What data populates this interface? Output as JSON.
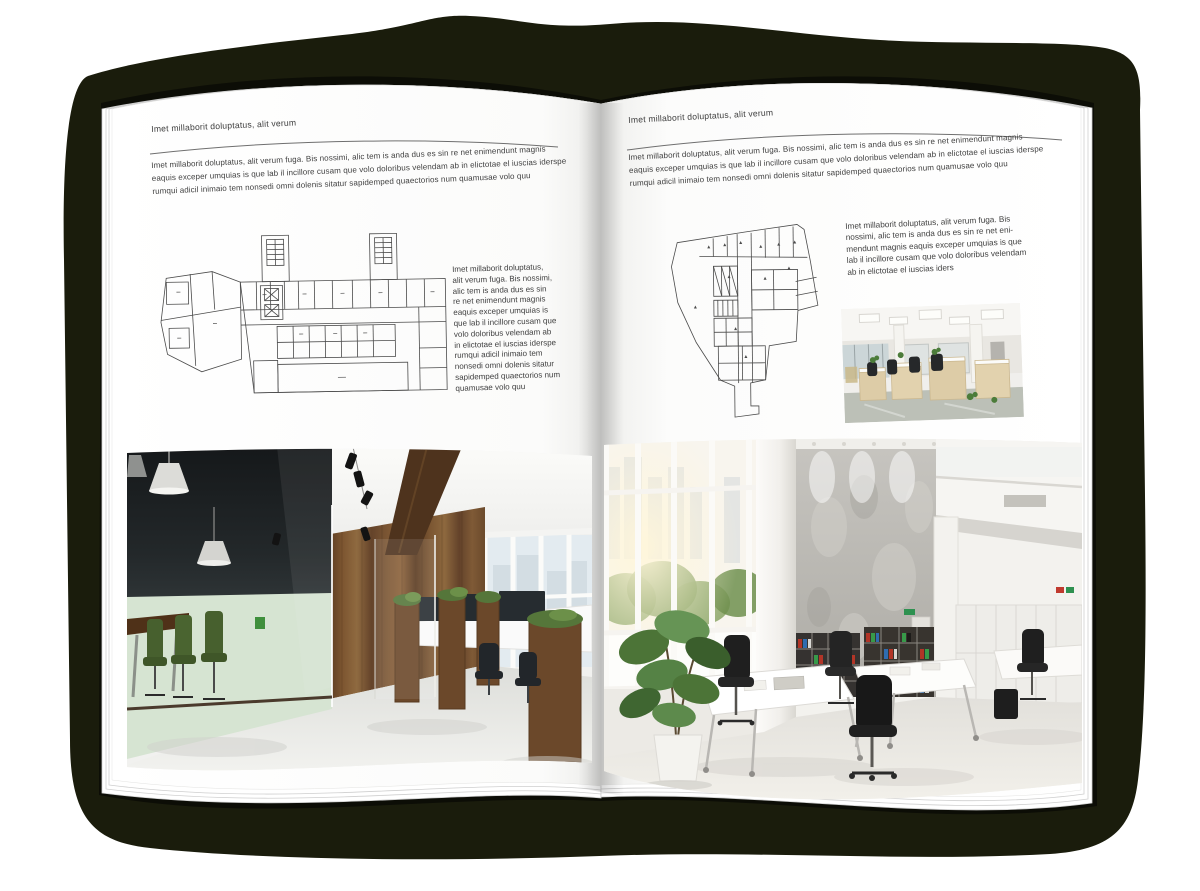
{
  "document": {
    "kind": "open-magazine-spread-mockup"
  },
  "colors": {
    "canvas": "#ffffff",
    "backdrop": "#1a1c0c",
    "cover": "#0c0d06",
    "page": "#ffffff",
    "text": "#3e3e3e",
    "rule": "#6f6f6f",
    "plan_line": "#4b4b4b",
    "wood": "#7a5533",
    "meeting_floor_green": "#d6e4d2",
    "chair_green": "#47602e",
    "binder_red": "#b23527",
    "binder_blue": "#2f6cb0",
    "binder_green": "#379a49",
    "plant_green": "#4c7437"
  },
  "left_page": {
    "header": "Imet millaborit doluptatus, alit verum",
    "intro_lines": [
      "Imet millaborit doluptatus, alit verum fuga. Bis nossimi, alic tem is anda dus es sin re net enimendunt magnis",
      "eaquis exceper umquias is que lab il incillore cusam que volo doloribus velendam ab in elictotae el iuscias iderspe",
      "rumqui adicil inimaio tem nonsedi omni dolenis sitatur sapidemped quaectorios num quamusae volo quu"
    ],
    "side_lines": [
      "Imet millaborit doluptatus,",
      "alit verum fuga. Bis nossimi,",
      "alic tem is anda dus es sin",
      "re net enimendunt magnis",
      "eaquis exceper umquias is",
      "que lab il incillore cusam que",
      "volo doloribus velendam ab",
      "in elictotae el iuscias iderspe",
      "rumqui adicil inimaio tem",
      "nonsedi omni dolenis sitatur",
      "sapidemped quaectorios num",
      "quamusae volo quu"
    ]
  },
  "right_page": {
    "header": "Imet millaborit doluptatus, alit verum",
    "intro_lines": [
      "Imet millaborit doluptatus, alit verum fuga. Bis nossimi, alic tem is anda dus es sin re net enimendunt magnis",
      "eaquis exceper umquias is que lab il incillore cusam que volo doloribus velendam ab in elictotae el iuscias iderspe",
      "rumqui adicil inimaio tem nonsedi omni dolenis sitatur sapidemped quaectorios num quamusae volo quu"
    ],
    "side_lines": [
      "Imet millaborit doluptatus, alit verum fuga. Bis",
      "nossimi, alic tem is anda dus es sin re net eni-",
      "mendunt magnis eaquis exceper umquias is que",
      "lab il incillore cusam que volo doloribus velendam",
      "ab in elictotae el iuscias iders"
    ]
  }
}
